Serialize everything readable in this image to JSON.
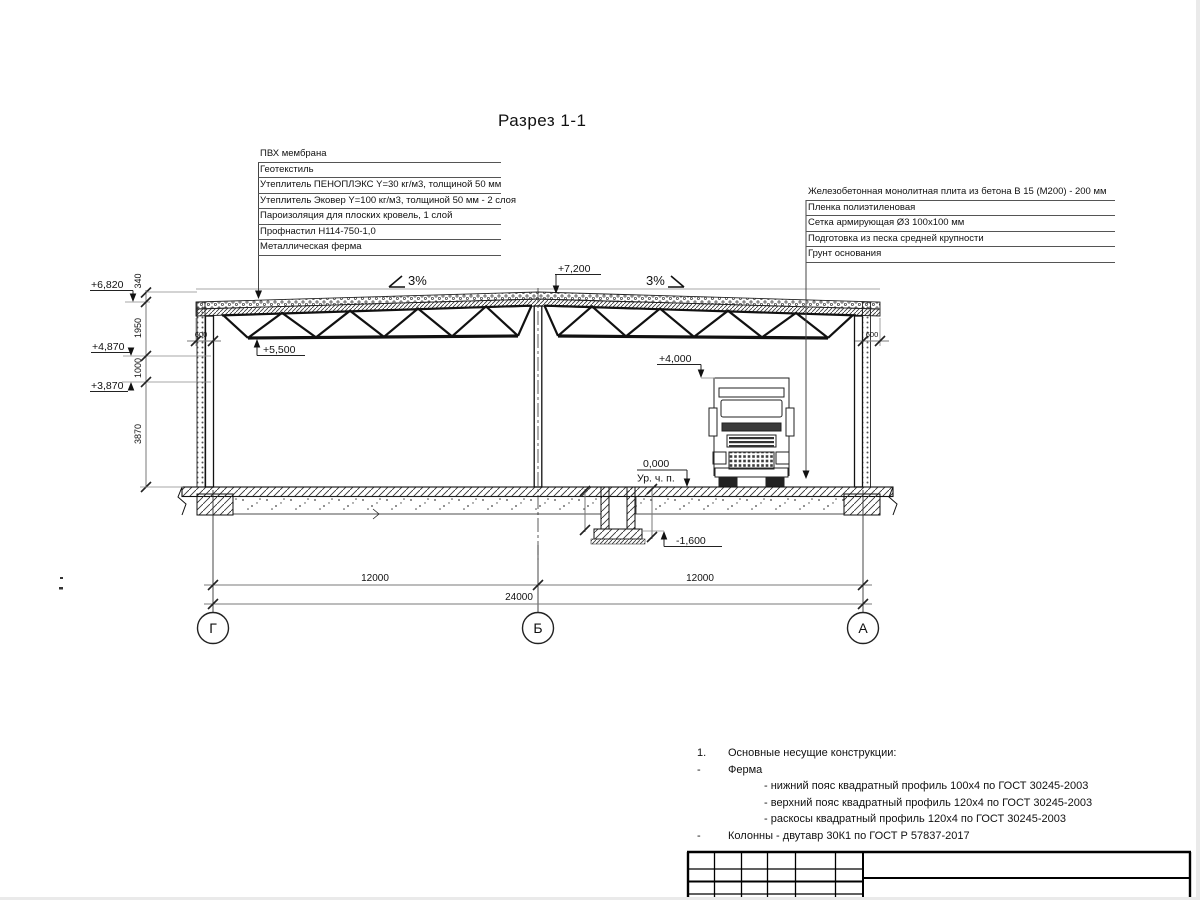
{
  "drawing": {
    "title": "Разрез 1-1",
    "roof_callouts": {
      "items": [
        "ПВХ мембрана",
        "Геотекстиль",
        "Утеплитель ПЕНОПЛЭКС Y=30 кг/м3, толщиной 50 мм",
        "Утеплитель Эковер Y=100 кг/м3, толщиной 50 мм - 2 слоя",
        "Пароизоляция для плоских кровель, 1 слой",
        "Профнастил Н114-750-1,0",
        "Металлическая ферма"
      ]
    },
    "floor_callouts": {
      "items": [
        "Железобетонная монолитная плита из бетона В 15 (М200) - 200 мм",
        "Пленка полиэтиленовая",
        "Сетка армирующая Ø3 100х100 мм",
        "Подготовка из песка средней крупности",
        "Грунт основания"
      ]
    },
    "elevations": {
      "ridge": "+7,200",
      "eave": "+6,820",
      "wall_mid": "+4,870",
      "wall_low": "+3,870",
      "truss_bottom": "+5,500",
      "clearance": "+4,000",
      "floor": "0,000",
      "floor_label": "Ур. ч. п.",
      "pit": "-1,600"
    },
    "slopes": {
      "left": "3%",
      "right": "3%"
    },
    "dimensions": {
      "chain": [
        "340",
        "1950",
        "1000",
        "3870"
      ],
      "overhang_left": "600",
      "overhang_right": "600",
      "span_left": "12000",
      "span_right": "12000",
      "total": "24000"
    },
    "axes": {
      "left": "Г",
      "middle": "Б",
      "right": "А"
    },
    "notes": {
      "item1_num": "1.",
      "item1": "Основные несущие конструкции:",
      "item2_marker": "-",
      "item2": "Ферма",
      "subitems": [
        "- нижний пояс квадратный профиль 100х4 по ГОСТ 30245-2003",
        "- верхний пояс квадратный профиль 120х4 по ГОСТ 30245-2003",
        "- раскосы квадратный профиль 120х4 по ГОСТ 30245-2003"
      ],
      "item3_marker": "-",
      "item3": "Колонны - двутавр 30К1 по ГОСТ Р 57837-2017"
    }
  }
}
